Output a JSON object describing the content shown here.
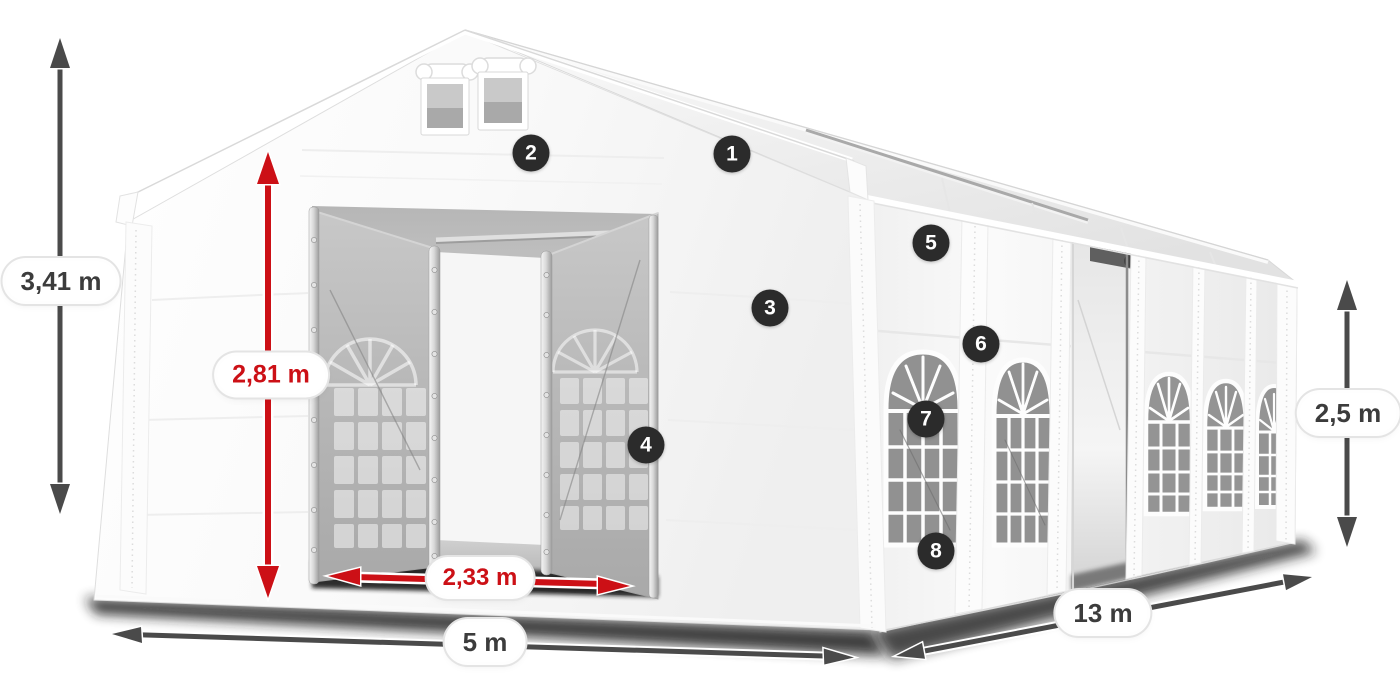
{
  "diagram": {
    "subject": "party-tent-dimension-diagram",
    "dimensions": {
      "total_height": "3,41 m",
      "entrance_height": "2,81 m",
      "entrance_width": "2,33 m",
      "front_width": "5 m",
      "side_length": "13 m",
      "side_wall_height": "2,5 m"
    },
    "callouts": [
      {
        "number": "1"
      },
      {
        "number": "2"
      },
      {
        "number": "3"
      },
      {
        "number": "4"
      },
      {
        "number": "5"
      },
      {
        "number": "6"
      },
      {
        "number": "7"
      },
      {
        "number": "8"
      }
    ],
    "colors": {
      "arrow_dark": "#4a4a4a",
      "arrow_red": "#cc1016",
      "label_text_dark": "#3c3c3c",
      "label_text_red": "#cc1016",
      "badge_bg": "#2b2b2b",
      "badge_text": "#ffffff",
      "background": "#ffffff"
    }
  }
}
